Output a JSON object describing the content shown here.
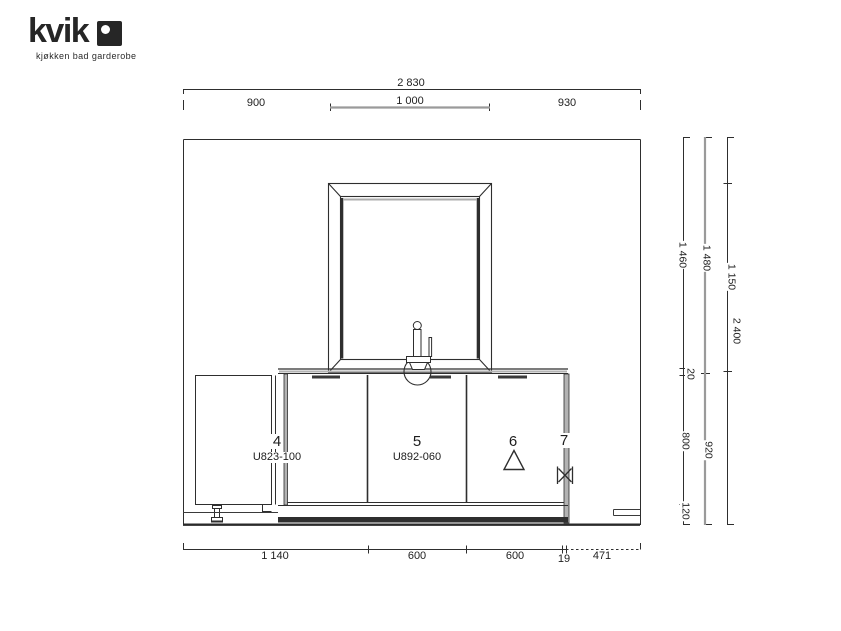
{
  "logo": {
    "brand": "kvik",
    "tagline": "kjøkken bad garderobe"
  },
  "dims": {
    "total_width": "2 830",
    "w_left": "900",
    "w_mirror": "1 000",
    "w_right": "930",
    "b1": "1 140",
    "b2": "600",
    "b3": "600",
    "b4": "19",
    "b5": "471",
    "r1a": "1 460",
    "r1b": "20",
    "r1c": "800",
    "r1d": "120",
    "r2a": "1 480",
    "r2b": "920",
    "r3a": "1 150",
    "r3b": "2 400"
  },
  "items": {
    "c4_no": "4",
    "c4_code": "U823-100",
    "c5_no": "5",
    "c5_code": "U892-060",
    "i6_no": "6",
    "i7_no": "7"
  },
  "symbols": {
    "item6": "triangle-icon",
    "item7": "valve-icon"
  },
  "colors": {
    "line": "#2e2e2e",
    "gray": "#9a9a9a",
    "plinth": "#2f2f2f"
  }
}
